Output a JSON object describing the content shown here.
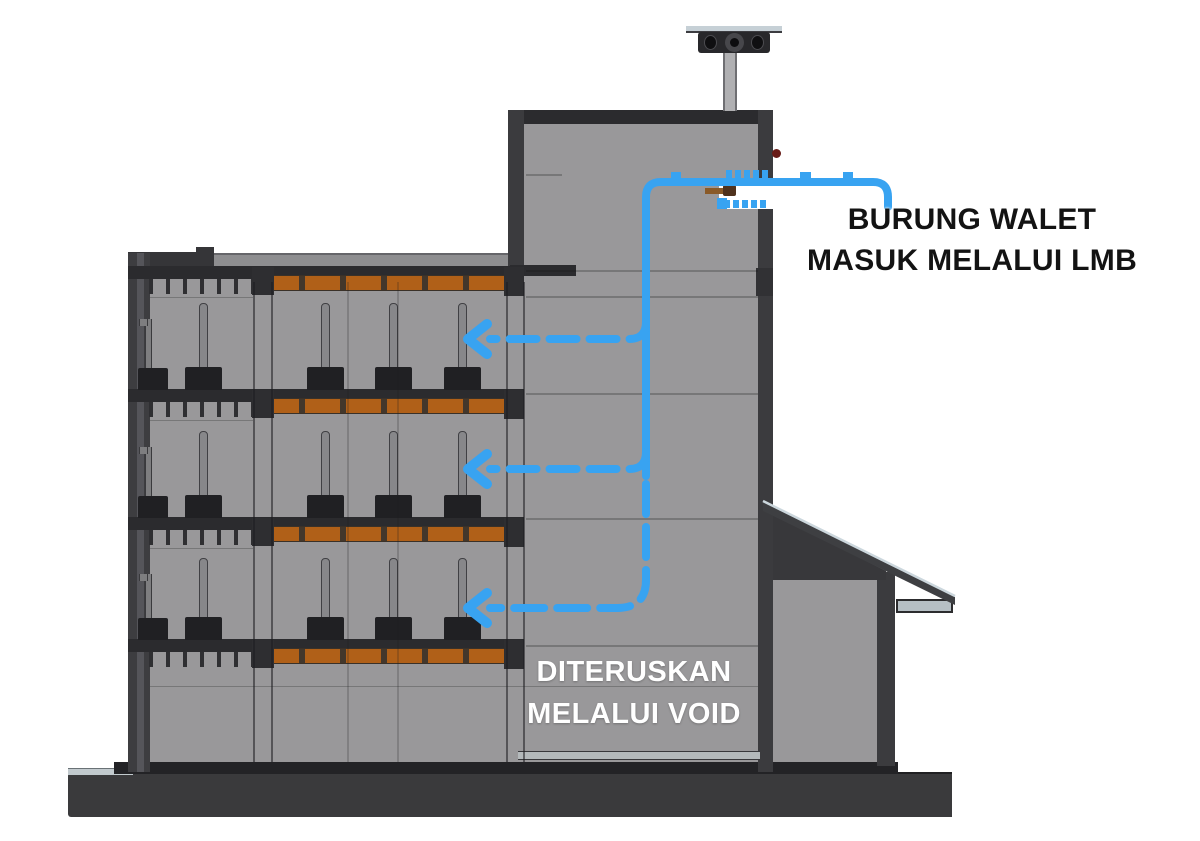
{
  "labels": {
    "entry": {
      "line1": "BURUNG WALET",
      "line2": "MASUK MELALUI LMB"
    },
    "void": {
      "line1": "DITERUSKAN",
      "line2": "MELALUI VOID"
    }
  },
  "colors": {
    "arrow_blue": "#38a3f1",
    "plank_orange": "#b06018",
    "wall_gray": "#99989a",
    "structure_dark": "#3b3b3e",
    "plinth_dark": "#3a3a3c",
    "label_black": "#131313",
    "label_white": "#ffffff",
    "roof_edge_light": "#ccd7dd",
    "perch_brown": "#8a5a28",
    "indicator_red": "#681c18"
  },
  "diagram": {
    "type": "building-cross-section",
    "subject": "swiftlet-house-bird-entry-flow",
    "nesting_floors_with_poles": 3,
    "nesting_plank_rows": 4,
    "flow_branch_arrows": 3,
    "elements": [
      "rooftop-speaker-ventilator",
      "entrance-tower",
      "lmb-entrance-hole",
      "void-shaft",
      "nesting-floors",
      "side-annex-roof",
      "base-plinth"
    ]
  }
}
